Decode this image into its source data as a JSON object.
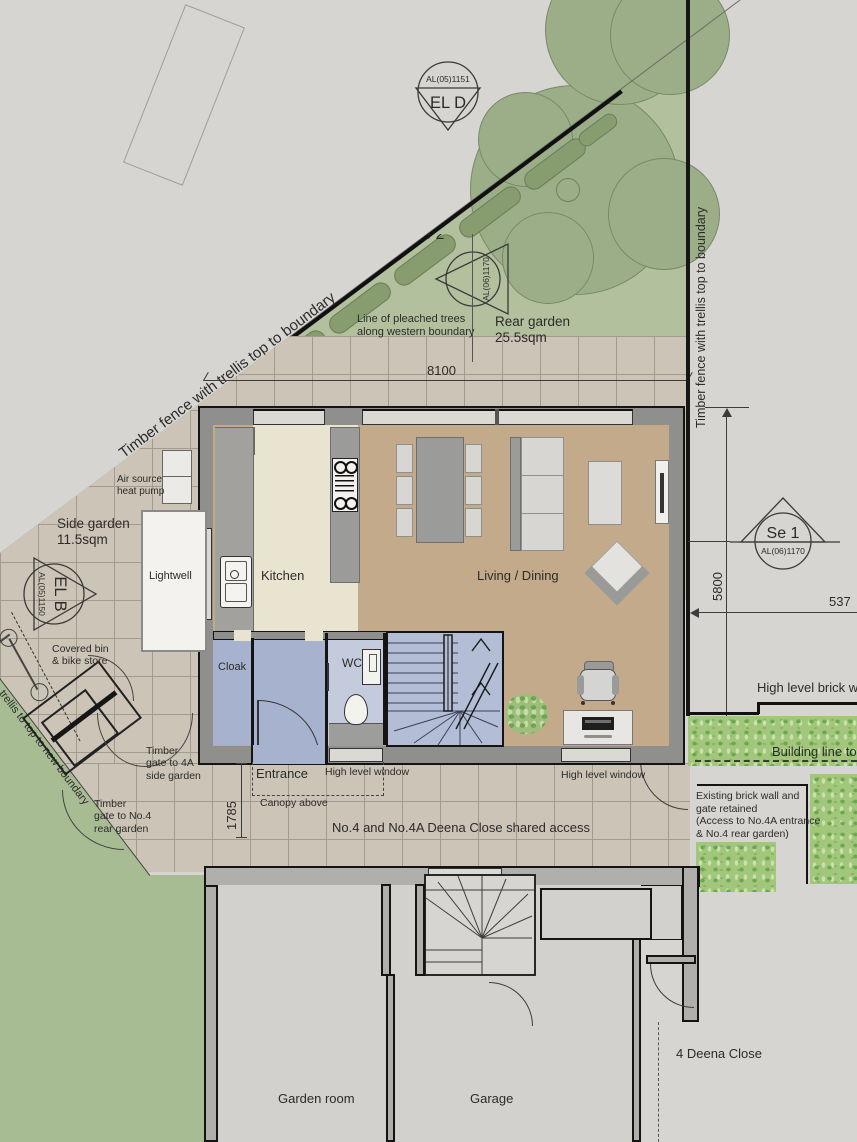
{
  "markers": {
    "el_d": {
      "label": "EL D",
      "code": "AL(05)1151"
    },
    "se_2": {
      "label": "Se 2",
      "code": "AL(06)1170"
    },
    "se_1": {
      "label": "Se 1",
      "code": "AL(06)1170"
    },
    "el_b": {
      "label": "EL B",
      "code": "AL(05)1150"
    }
  },
  "boundaries": {
    "fence_nw": "Timber fence with trellis top to boundary",
    "fence_east": "Timber fence with trellis top to boundary",
    "fence_sw": "trellis to top to new boundary"
  },
  "garden": {
    "pleached1": "Line of pleached trees",
    "pleached2": "along western boundary",
    "rear_name": "Rear garden",
    "rear_area": "25.5sqm",
    "side_name": "Side garden",
    "side_area": "11.5sqm"
  },
  "rooms": {
    "kitchen": "Kitchen",
    "living": "Living / Dining",
    "cloak": "Cloak",
    "wc": "WC",
    "entrance": "Entrance",
    "lightwell": "Lightwell",
    "garden_room": "Garden room",
    "garage": "Garage"
  },
  "annotations": {
    "air1": "Air source",
    "air2": "heat pump",
    "hlw": "High level window",
    "canopy": "Canopy above",
    "bin1": "Covered bin",
    "bin2": "& bike store",
    "gate4a1": "Timber",
    "gate4a2": "gate to 4A",
    "gate4a3": "side garden",
    "gate41": "Timber",
    "gate42": "gate to No.4",
    "gate43": "rear garden",
    "shared": "No.4 and No.4A Deena Close shared access",
    "brick_wall": "High level brick w",
    "building_line": "Building line to",
    "existing1": "Existing brick wall and",
    "existing2": "gate retained",
    "existing3": "(Access to No.4A entrance",
    "existing4": "& No.4 rear garden)",
    "address": "4 Deena Close"
  },
  "dimensions": {
    "width": "8100",
    "depth": "5800",
    "front": "1785",
    "right": "537"
  }
}
